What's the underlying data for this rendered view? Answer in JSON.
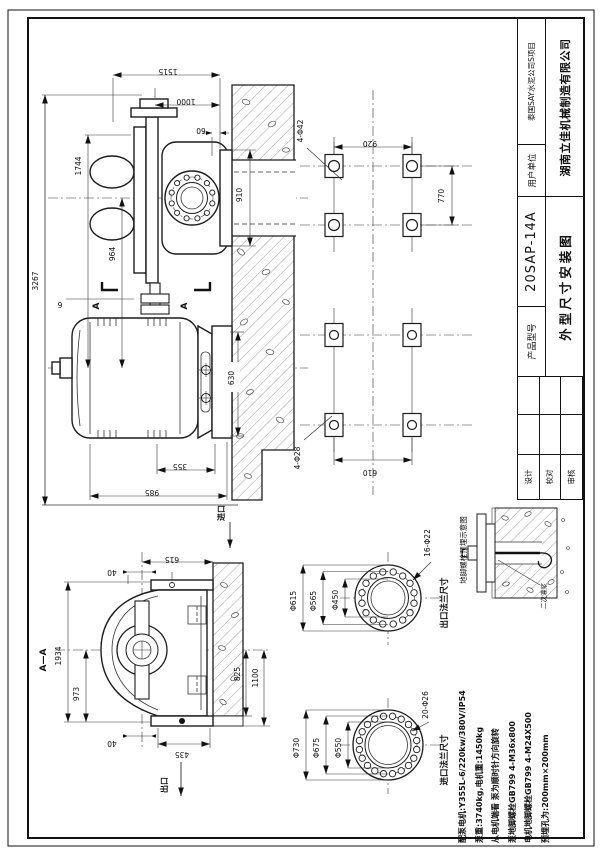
{
  "title_block": {
    "customer_label": "用户单位",
    "customer": "泰国SAY水泥公司S项目",
    "company": "湖南立佳机械制造有限公司",
    "model_label": "产品型号",
    "model": "20SAP-14A",
    "drawing_title": "外型尺寸安装图",
    "sign_labels": [
      "设计",
      "校对",
      "审核"
    ]
  },
  "notes": {
    "lines": [
      "配泵电机:Y355L-6/220kw/380V/IP54",
      "泵重:3740kg,电机重:1450kg",
      "从电机端看 泵为顺时针方向旋转",
      "泵地脚螺栓GB799 4-M36x800",
      "电机地脚螺栓GB799 4-M24X500",
      "预埋孔为:200mm×200mm"
    ]
  },
  "views": {
    "main": {
      "dims": {
        "v3267": "3267",
        "v1744": "1744",
        "v964": "964",
        "v1515": "1515",
        "v1000": "1000",
        "v60": "60",
        "v6": "6",
        "v355": "355",
        "v985": "985",
        "v630": "630",
        "v910": "910"
      },
      "cut_label": "A",
      "inlet_label": "进口"
    },
    "plan": {
      "pump_holes": "4-Φ42",
      "motor_holes": "4-Φ28",
      "v920": "920",
      "v770": "770",
      "v610": "610"
    },
    "section": {
      "label": "A—A",
      "v1934": "1934",
      "v973": "973",
      "v40a": "40",
      "v40b": "40",
      "v615": "615",
      "v435": "435",
      "v825": "825",
      "v1100": "1100",
      "outlet_label": "出口"
    },
    "outlet_flange": {
      "title": "出口法兰尺寸",
      "holes": "16-Φ22",
      "d1": "Φ615",
      "d2": "Φ565",
      "d3": "Φ450"
    },
    "inlet_flange": {
      "title": "进口法兰尺寸",
      "holes": "20-Φ26",
      "d1": "Φ730",
      "d2": "Φ675",
      "d3": "Φ550"
    },
    "anchor": {
      "title": "地脚螺栓预埋示意图",
      "grout": "二次灌浆"
    }
  }
}
